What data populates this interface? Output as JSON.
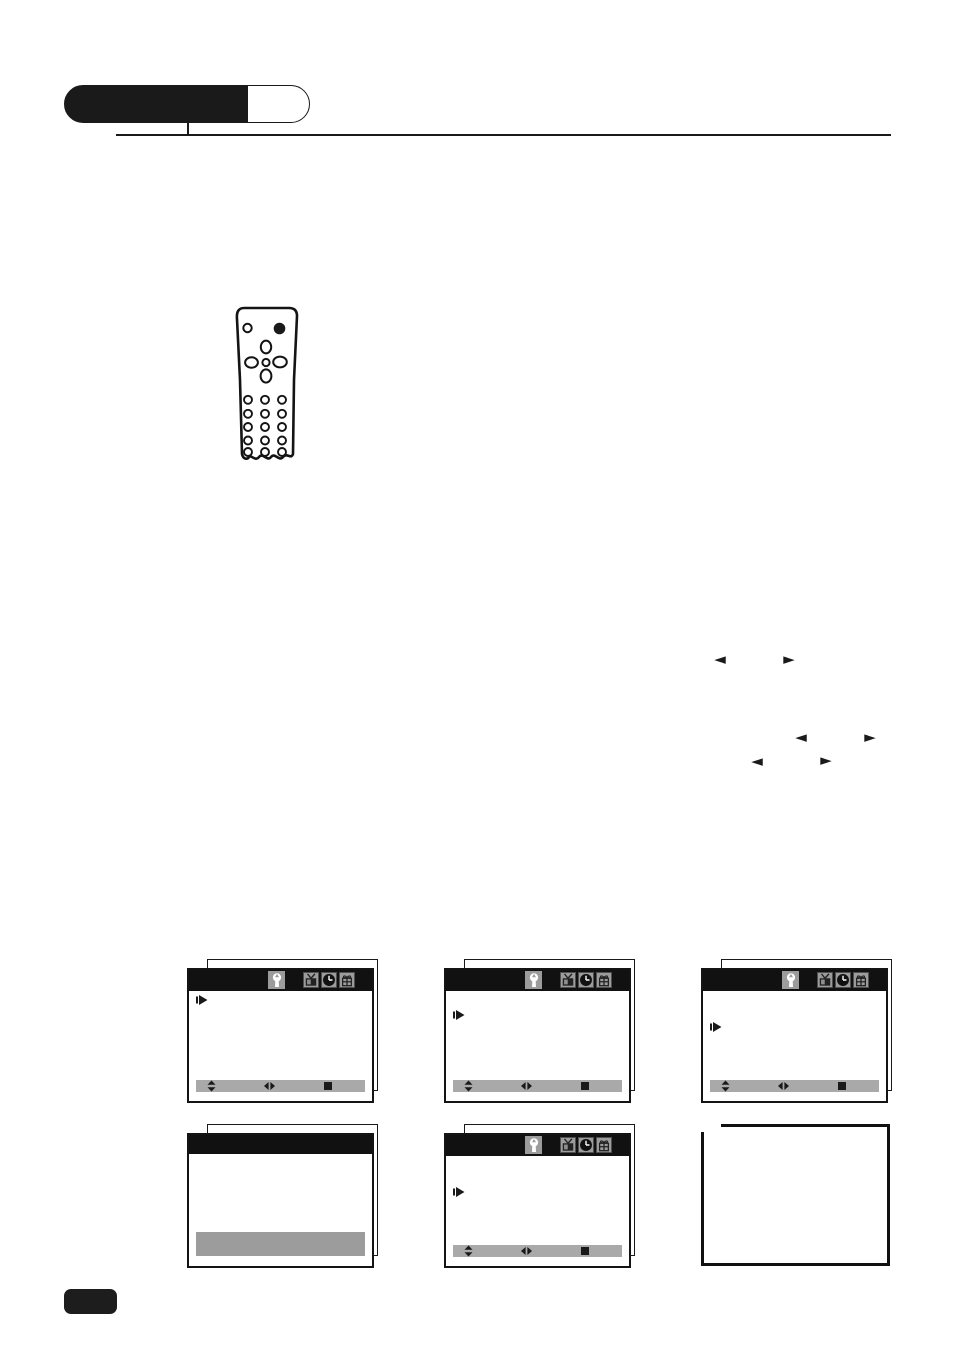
{
  "colors": {
    "ink": "#1a1a1a",
    "icon_box_gray": "#9c9c9c",
    "control_bar_gray": "#a9a9a9",
    "highlight_gray": "#9c9c9c",
    "screen_background": "#ffffff"
  },
  "header": {
    "badge_style": "pill, left portion filled black, right portion white outlined"
  },
  "remote": {
    "buttons": [
      "indicator-dot",
      "power-button",
      "dpad-up",
      "dpad-left",
      "dpad-center",
      "dpad-right",
      "dpad-down"
    ],
    "button_grid": {
      "rows": 5,
      "cols": 3
    }
  },
  "inline_arrows": [
    {
      "glyph": "◄"
    },
    {
      "glyph": "►"
    },
    {
      "glyph": "◄"
    },
    {
      "glyph": "►"
    },
    {
      "glyph": "◄"
    },
    {
      "glyph": "►"
    }
  ],
  "menu_screens": {
    "titlebar_icons": [
      "wrench-icon",
      "tv-icon",
      "clock-icon",
      "gift-icon"
    ],
    "active_icon": "wrench-icon",
    "control_bar_glyphs": [
      "up-down-arrows",
      "left-right-arrows",
      "stop-square"
    ],
    "screens": [
      {
        "variant": "menu",
        "cursor_row": 1
      },
      {
        "variant": "menu",
        "cursor_row": 2
      },
      {
        "variant": "menu",
        "cursor_row": 3
      },
      {
        "variant": "plain-highlight"
      },
      {
        "variant": "menu",
        "cursor_row": 3
      },
      {
        "variant": "empty-frame"
      }
    ]
  },
  "footer": {
    "badge_style": "small black rounded rectangle (page number block, no text rendered)"
  }
}
